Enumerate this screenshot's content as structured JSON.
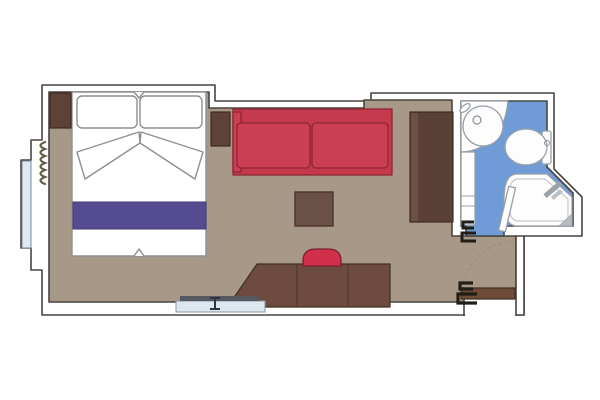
{
  "diagram": {
    "type": "floor-plan",
    "subject": "cruise-ship-cabin-stateroom",
    "rooms": {
      "bedroom": [
        "double-bed",
        "pillows",
        "folded-duvet",
        "bed-runner",
        "nightstand-left",
        "nightstand-right",
        "curtain",
        "balcony-window",
        "sofa",
        "coffee-table",
        "wardrobe",
        "desk",
        "stool",
        "luggage-bench"
      ],
      "bathroom": [
        "vanity-counter",
        "washbasin",
        "faucet",
        "shelf-unit",
        "toilet",
        "shower",
        "shower-seat",
        "bathroom-door"
      ],
      "entry": [
        "entrance-door",
        "door-swing-arc",
        "door-handles"
      ]
    }
  },
  "colors": {
    "background": "#ffffff",
    "wall_fill": "#ffffff",
    "wall_line": "#494440",
    "floor": "#a89887",
    "bathroom_floor": "#6f9cd6",
    "window_glass": "#dde9f3",
    "curtain": "#6a5942",
    "bed_white": "#ffffff",
    "bed_runner": "#554b90",
    "runner_line": "#453a7a",
    "wood_dark": "#5e4237",
    "wardrobe": "#5a4035",
    "wardrobe_light": "#6c5143",
    "desk": "#6d4c3f",
    "table": "#6b5047",
    "sofa": "#c43a4c",
    "sofa_cushion": "#ca4052",
    "stool": "#d03049",
    "bench": "#dce7f0",
    "bench_bar": "#54595f",
    "bench_clamp": "#30363b",
    "entry_door": "#6f4c38",
    "fixture_fill": "#fdfdfd",
    "fixture_line": "#97a0a8",
    "shower_seat": "#b8bcc0",
    "handle": "#211d19",
    "swing_arc": "#9b8d7c"
  }
}
